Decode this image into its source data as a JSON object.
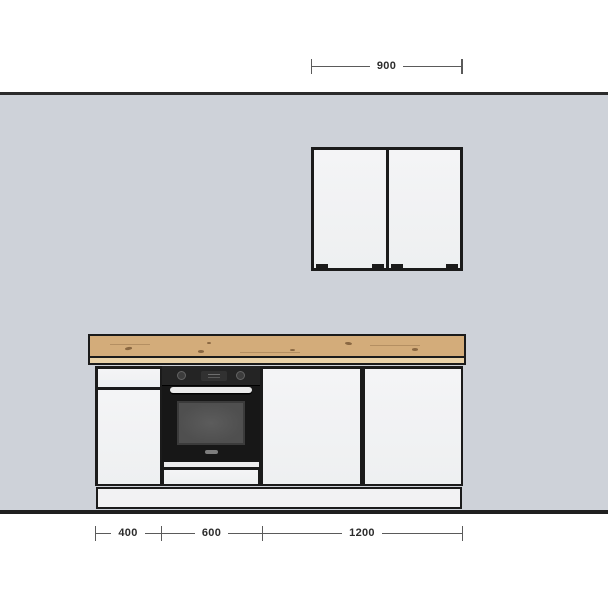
{
  "scene": {
    "type": "kitchen-elevation-drawing",
    "objects": [
      "wall",
      "double-door-wall-cabinet",
      "wood-countertop",
      "built-in-oven",
      "base-cabinet-run",
      "plinth"
    ]
  },
  "dimensions": {
    "top": {
      "label": "900"
    },
    "bottom": [
      {
        "label": "400"
      },
      {
        "label": "600"
      },
      {
        "label": "1200"
      }
    ]
  },
  "icons": {
    "oven_knob": "circle-dial",
    "oven_display": "rounded-rect-lcd",
    "oven_handle": "horizontal-bar",
    "cabinet_handle": "small-bar"
  },
  "colors": {
    "bg": "#ffffff",
    "wall": "#ced2d9",
    "wall_line": "#2b2b2b",
    "outline": "#1b1b1b",
    "front": "#f2f2f3",
    "gap_strip": "#ededee",
    "wood": "#d3ac7a",
    "wood_knot": "#7d5c38",
    "wood_edge": "#e9d2a8",
    "oven_body": "#171717",
    "oven_panel": "#242424",
    "oven_window": "#4f4f4f",
    "oven_handle": "#e9e9e9",
    "dim_line": "#5a5a5a",
    "dim_text": "#2c2c2c"
  }
}
